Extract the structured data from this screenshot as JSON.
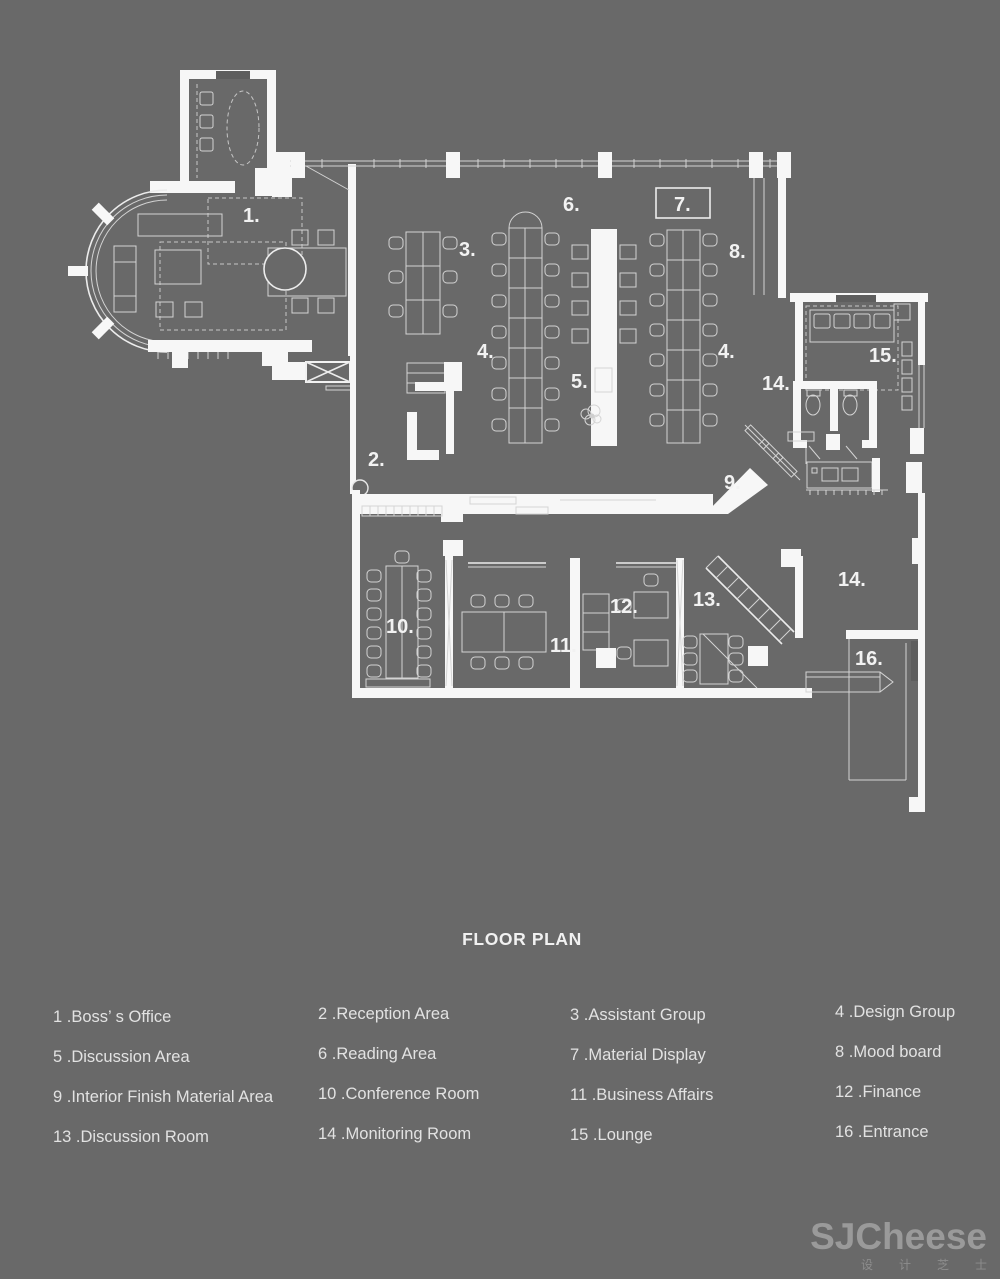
{
  "title": "FLOOR PLAN",
  "plan": {
    "labels": [
      {
        "room": "1",
        "text": "1."
      },
      {
        "room": "2",
        "text": "2."
      },
      {
        "room": "3",
        "text": "3."
      },
      {
        "room": "4a",
        "text": "4."
      },
      {
        "room": "4b",
        "text": "4."
      },
      {
        "room": "5",
        "text": "5."
      },
      {
        "room": "6",
        "text": "6."
      },
      {
        "room": "7",
        "text": "7."
      },
      {
        "room": "8",
        "text": "8."
      },
      {
        "room": "9",
        "text": "9."
      },
      {
        "room": "10",
        "text": "10."
      },
      {
        "room": "11",
        "text": "11."
      },
      {
        "room": "12",
        "text": "12."
      },
      {
        "room": "13",
        "text": "13."
      },
      {
        "room": "14a",
        "text": "14."
      },
      {
        "room": "14b",
        "text": "14."
      },
      {
        "room": "15",
        "text": "15."
      },
      {
        "room": "16",
        "text": "16."
      }
    ]
  },
  "legend": {
    "columns": [
      {
        "items": [
          "1 .Boss’ s Office",
          "5 .Discussion Area",
          "9 .Interior Finish Material Area",
          "13 .Discussion Room"
        ]
      },
      {
        "items": [
          "2 .Reception Area",
          "6 .Reading Area",
          "10 .Conference Room",
          "14 .Monitoring Room"
        ]
      },
      {
        "items": [
          "3 .Assistant Group",
          "7 .Material Display",
          "11 .Business Affairs",
          "15 .Lounge"
        ]
      },
      {
        "items": [
          "4 .Design Group",
          "8 .Mood board",
          "12 .Finance",
          "16 .Entrance"
        ]
      }
    ]
  },
  "watermark": {
    "brand": "SJCheese",
    "caption": "设计芝士"
  },
  "colors": {
    "background": "#696969",
    "wall": "#f7f7f7",
    "furniture_line": "#d4d4d4",
    "text": "#e2e2e2",
    "watermark": "#9a9a9a"
  }
}
